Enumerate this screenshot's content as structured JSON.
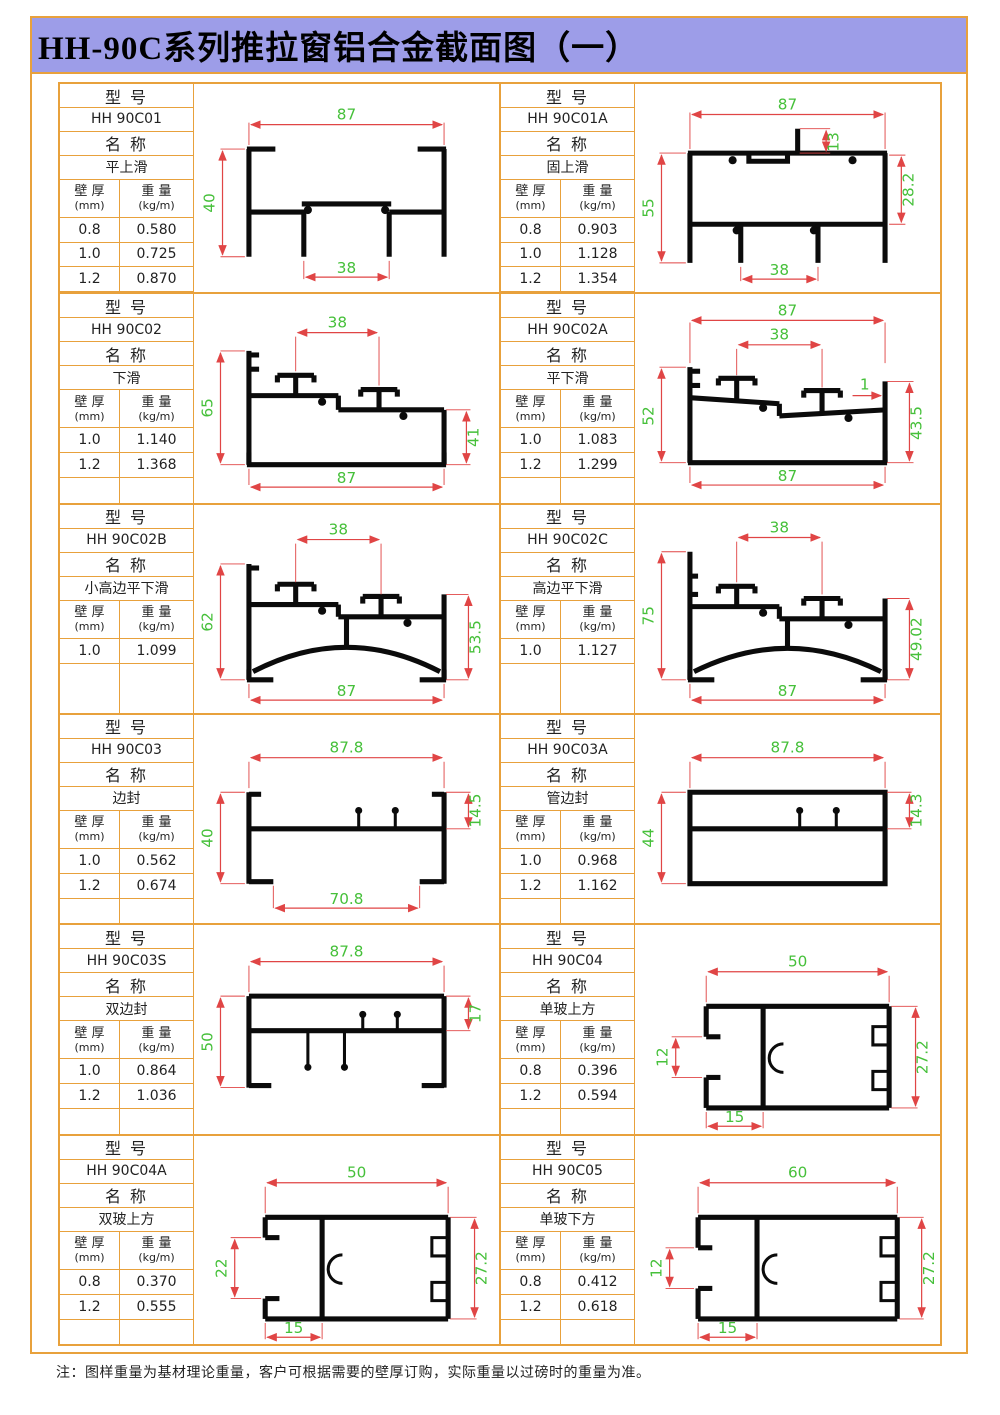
{
  "title": "HH-90C系列推拉窗铝合金截面图（一）",
  "note": "注：图样重量为基材理论重量，客户可根据需要的壁厚订购，实际重量以过磅时的重量为准。",
  "labels": {
    "model": "型    号",
    "name": "名    称",
    "thickness": "壁 厚",
    "thickness_unit": "(mm)",
    "weight": "重 量",
    "weight_unit": "(kg/m)"
  },
  "colors": {
    "border_orange": "#E8A13C",
    "title_bg": "#9D9DE8",
    "dim_line_red": "#E04545",
    "dim_text_green": "#46C03A",
    "profile_black": "#0B0B0B"
  },
  "cells": [
    {
      "model": "HH 90C01",
      "name": "平上滑",
      "rows": [
        [
          "0.8",
          "0.580"
        ],
        [
          "1.0",
          "0.725"
        ],
        [
          "1.2",
          "0.870"
        ]
      ],
      "dims": {
        "top": "87",
        "left": "40",
        "bottom": "38"
      }
    },
    {
      "model": "HH 90C01A",
      "name": "固上滑",
      "rows": [
        [
          "0.8",
          "0.903"
        ],
        [
          "1.0",
          "1.128"
        ],
        [
          "1.2",
          "1.354"
        ]
      ],
      "dims": {
        "top": "87",
        "tab": "13",
        "left": "55",
        "right": "28.2",
        "bottom": "38"
      }
    },
    {
      "model": "HH 90C02",
      "name": "下滑",
      "rows": [
        [
          "1.0",
          "1.140"
        ],
        [
          "1.2",
          "1.368"
        ]
      ],
      "dims": {
        "top": "38",
        "left": "65",
        "right": "41",
        "bottom": "87"
      }
    },
    {
      "model": "HH 90C02A",
      "name": "平下滑",
      "rows": [
        [
          "1.0",
          "1.083"
        ],
        [
          "1.2",
          "1.299"
        ]
      ],
      "dims": {
        "top": "87",
        "inner": "38",
        "left": "52",
        "small": "1",
        "right": "43.5",
        "bottom": "87"
      }
    },
    {
      "model": "HH 90C02B",
      "name": "小高边平下滑",
      "rows": [
        [
          "1.0",
          "1.099"
        ]
      ],
      "dims": {
        "top": "38",
        "left": "62",
        "right": "53.5",
        "bottom": "87"
      }
    },
    {
      "model": "HH 90C02C",
      "name": "高边平下滑",
      "rows": [
        [
          "1.0",
          "1.127"
        ]
      ],
      "dims": {
        "top": "38",
        "left": "75",
        "right": "49.02",
        "bottom": "87"
      }
    },
    {
      "model": "HH 90C03",
      "name": "边封",
      "rows": [
        [
          "1.0",
          "0.562"
        ],
        [
          "1.2",
          "0.674"
        ]
      ],
      "dims": {
        "top": "87.8",
        "left": "40",
        "right": "14.5",
        "bottom": "70.8"
      }
    },
    {
      "model": "HH 90C03A",
      "name": "管边封",
      "rows": [
        [
          "1.0",
          "0.968"
        ],
        [
          "1.2",
          "1.162"
        ]
      ],
      "dims": {
        "top": "87.8",
        "left": "44",
        "right": "14.3"
      }
    },
    {
      "model": "HH 90C03S",
      "name": "双边封",
      "rows": [
        [
          "1.0",
          "0.864"
        ],
        [
          "1.2",
          "1.036"
        ]
      ],
      "dims": {
        "top": "87.8",
        "left": "50",
        "right": "17"
      }
    },
    {
      "model": "HH 90C04",
      "name": "单玻上方",
      "rows": [
        [
          "0.8",
          "0.396"
        ],
        [
          "1.2",
          "0.594"
        ]
      ],
      "dims": {
        "top": "50",
        "left": "12",
        "right": "27.2",
        "bottom": "15"
      }
    },
    {
      "model": "HH 90C04A",
      "name": "双玻上方",
      "rows": [
        [
          "0.8",
          "0.370"
        ],
        [
          "1.2",
          "0.555"
        ]
      ],
      "dims": {
        "top": "50",
        "left": "22",
        "right": "27.2",
        "bottom": "15"
      }
    },
    {
      "model": "HH 90C05",
      "name": "单玻下方",
      "rows": [
        [
          "0.8",
          "0.412"
        ],
        [
          "1.2",
          "0.618"
        ]
      ],
      "dims": {
        "top": "60",
        "left": "12",
        "right": "27.2",
        "bottom": "15"
      }
    }
  ]
}
